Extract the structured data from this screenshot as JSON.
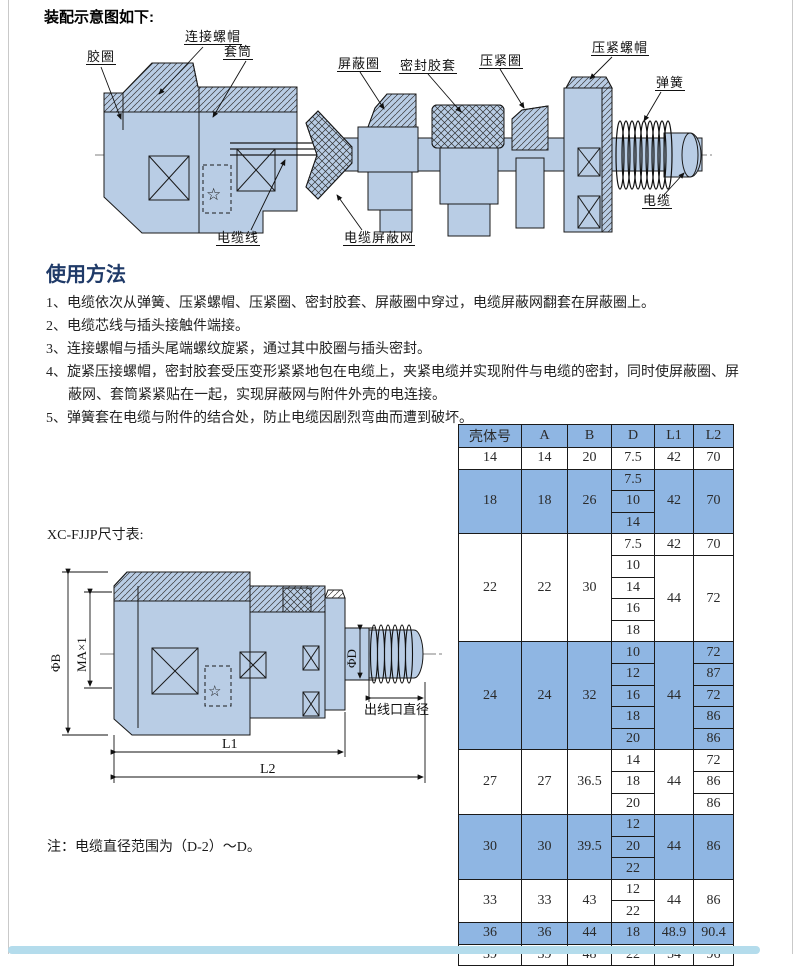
{
  "page": {
    "title": "装配示意图如下:",
    "border_color": "#c9c9c9",
    "scrollbar_color": "#b4dcec"
  },
  "colors": {
    "part_fill": "#b9cde5",
    "table_blue": "#8fb6e3",
    "heading_navy": "#1f3a68"
  },
  "assembly": {
    "labels": {
      "jiaoquan": "胶圈",
      "lianjie_luomao": "连接螺帽",
      "taotong": "套筒",
      "pingbiquan": "屏蔽圈",
      "mifeng_jiaotao": "密封胶套",
      "yajinquan": "压紧圈",
      "yajin_luomao": "压紧螺帽",
      "tanhuang": "弹簧",
      "dianlan": "电缆",
      "dianlanxian": "电缆线",
      "dianlan_pingbiwang": "电缆屏蔽网"
    }
  },
  "usage": {
    "heading": "使用方法",
    "lines": [
      "1、电缆依次从弹簧、压紧螺帽、压紧圈、密封胶套、屏蔽圈中穿过，电缆屏蔽网翻套在屏蔽圈上。",
      "2、电缆芯线与插头接触件端接。",
      "3、连接螺帽与插头尾端螺纹旋紧，通过其中胶圈与插头密封。",
      "4、旋紧压接螺帽，密封胶套受压变形紧紧地包在电缆上，夹紧电缆并实现附件与电缆的密封，同时使屏蔽圈、屏",
      "蔽网、套筒紧紧贴在一起，实现屏蔽网与附件外壳的电连接。",
      "5、弹簧套在电缆与附件的结合处，防止电缆因剧烈弯曲而遭到破坏。"
    ]
  },
  "dimension": {
    "caption": "XC-FJJP尺寸表:",
    "note": "注：电缆直径范围为（D-2）～D。",
    "labels": {
      "phi_b": "ΦB",
      "thread": "MA×1",
      "phi_d": "ΦD",
      "outlet": "出线口直径",
      "l1": "L1",
      "l2": "L2"
    }
  },
  "table": {
    "headers": [
      "壳体号",
      "A",
      "B",
      "D",
      "L1",
      "L2"
    ],
    "col_widths": [
      62,
      45,
      43,
      42,
      38,
      39
    ],
    "groups": [
      {
        "shell": "14",
        "a": "14",
        "b": "20",
        "shaded": false,
        "rows": [
          {
            "d": "7.5",
            "l1": "42",
            "l1span": 1,
            "l2": "70",
            "l2span": 1
          }
        ]
      },
      {
        "shell": "18",
        "a": "18",
        "b": "26",
        "shaded": true,
        "rows": [
          {
            "d": "7.5",
            "l1": "42",
            "l1span": 3,
            "l2": "70",
            "l2span": 3
          },
          {
            "d": "10"
          },
          {
            "d": "14"
          }
        ]
      },
      {
        "shell": "22",
        "a": "22",
        "b": "30",
        "shaded": false,
        "rows": [
          {
            "d": "7.5",
            "l1": "42",
            "l1span": 1,
            "l2": "70",
            "l2span": 1
          },
          {
            "d": "10",
            "l1": "44",
            "l1span": 4,
            "l2": "72",
            "l2span": 4
          },
          {
            "d": "14"
          },
          {
            "d": "16"
          },
          {
            "d": "18"
          }
        ]
      },
      {
        "shell": "24",
        "a": "24",
        "b": "32",
        "shaded": true,
        "rows": [
          {
            "d": "10",
            "l1": "44",
            "l1span": 5,
            "l2": "72",
            "l2span": 1
          },
          {
            "d": "12",
            "l2": "87",
            "l2span": 1
          },
          {
            "d": "16",
            "l2": "72",
            "l2span": 1
          },
          {
            "d": "18",
            "l2": "86",
            "l2span": 1
          },
          {
            "d": "20",
            "l2": "86",
            "l2span": 1
          }
        ]
      },
      {
        "shell": "27",
        "a": "27",
        "b": "36.5",
        "shaded": false,
        "rows": [
          {
            "d": "14",
            "l1": "44",
            "l1span": 3,
            "l2": "72",
            "l2span": 1
          },
          {
            "d": "18",
            "l2": "86",
            "l2span": 1
          },
          {
            "d": "20",
            "l2": "86",
            "l2span": 1
          }
        ]
      },
      {
        "shell": "30",
        "a": "30",
        "b": "39.5",
        "shaded": true,
        "rows": [
          {
            "d": "12",
            "l1": "44",
            "l1span": 3,
            "l2": "86",
            "l2span": 3
          },
          {
            "d": "20"
          },
          {
            "d": "22"
          }
        ]
      },
      {
        "shell": "33",
        "a": "33",
        "b": "43",
        "shaded": false,
        "rows": [
          {
            "d": "12",
            "l1": "44",
            "l1span": 2,
            "l2": "86",
            "l2span": 2
          },
          {
            "d": "22"
          }
        ]
      },
      {
        "shell": "36",
        "a": "36",
        "b": "44",
        "shaded": true,
        "rows": [
          {
            "d": "18",
            "l1": "48.9",
            "l1span": 1,
            "l2": "90.4",
            "l2span": 1
          }
        ]
      },
      {
        "shell": "39",
        "a": "39",
        "b": "48",
        "shaded": false,
        "rows": [
          {
            "d": "22",
            "l1": "54",
            "l1span": 1,
            "l2": "96",
            "l2span": 1
          }
        ]
      }
    ]
  }
}
